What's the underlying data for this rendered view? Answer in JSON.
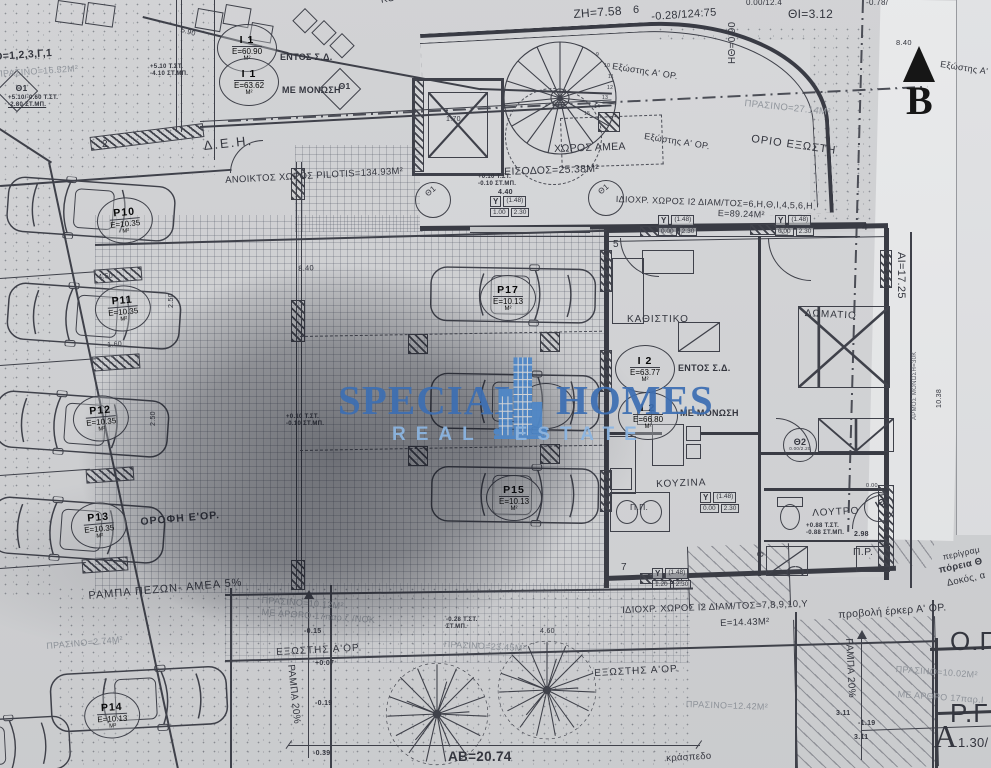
{
  "watermark": {
    "word1": "SPECIAL",
    "word2": "HOMES",
    "tagline": "REAL ESTATE",
    "brand_blue": "#3d6fb3",
    "tagline_blue": "#8cb6e3"
  },
  "north": {
    "label": "B"
  },
  "parking": {
    "p10": {
      "name": "P10",
      "area": "Ε=10.35",
      "unit": "Μ²"
    },
    "p11": {
      "name": "P11",
      "area": "Ε=10.35",
      "unit": "Μ²"
    },
    "p12": {
      "name": "P12",
      "area": "Ε=10.35",
      "unit": "Μ²"
    },
    "p13": {
      "name": "P13",
      "area": "Ε=10.35",
      "unit": "Μ²"
    },
    "p14": {
      "name": "P14",
      "area": "Ε=10.13",
      "unit": "Μ²"
    },
    "p15": {
      "name": "P15",
      "area": "Ε=10.13",
      "unit": "Μ²"
    },
    "p17": {
      "name": "P17",
      "area": "Ε=10.13",
      "unit": "Μ²"
    }
  },
  "units": {
    "i1a": {
      "name": "Ι 1",
      "area": "Ε=60.90",
      "unit": "Μ²",
      "note": "ΕΝΤΟΣ Σ.Δ."
    },
    "i1b": {
      "name": "Ι 1",
      "area": "Ε=63.62",
      "unit": "Μ²",
      "note": "ΜΕ ΜΟΝΩΣΗ"
    },
    "i2a": {
      "name": "Ι 2",
      "area": "Ε=63.77",
      "unit": "Μ²",
      "note": "ΕΝΤΟΣ Σ.Δ."
    },
    "i2b": {
      "name": "Ι 2",
      "area": "Ε=66.80",
      "unit": "Μ²",
      "note": "ΜΕ ΜΟΝΩΣΗ"
    }
  },
  "rooms": {
    "kouzina_top": "ΚΟΥΖΙΝΑ",
    "amea": "ΧΩΡΟΣ ΑΜΕΑ",
    "eisodos": "ΕΙΣΟΔΟΣ=25.38Μ²",
    "kathistiko": "ΚΑΘΙΣΤΙΚΟ",
    "domatio": "ΔΩΜΑΤΙΟ",
    "kouzina": "ΚΟΥΖΙΝΑ",
    "loutro": "ΛΟΥΤΡΟ",
    "pp": "Π.Π.",
    "pr": "Π.Ρ.",
    "pilotis": "ΑΝΟΙΚΤΟΣ ΧΩΡΟΣ PILOTIS=134.93Μ²"
  },
  "areas": {
    "plot_eq": "Ο=1,2,3,Γ,1",
    "prasino_tl": "ΠΡΑΣΙΝΟ=16.52Μ²",
    "prasino_27": "ΠΡΑΣΙΝΟ=27.14Μ²",
    "idioxr_top": "ΙΔΙΟΧΡ. ΧΩΡΟΣ Ι2 ΔΙΑΜ/ΤΟΣ=6,Η,Θ,Ι,4,5,6,Η",
    "e8924": "Ε=89.24Μ²",
    "idioxr_bottom": "ΙΔΙΟΧΡ. ΧΩΡΟΣ Ι2 ΔΙΑΜ/ΤΟΣ=7,8,9,10,Υ",
    "e1443": "Ε=14.43Μ²",
    "prasino_1012": "ΠΡΑΣΙΝΟ=10.12Μ²",
    "me_arthro_l": "ΜΕ ΑΡΘΡΟ 17παρ.ζ /ΝΟΚ",
    "prasino_274": "ΠΡΑΣΙΝΟ=2.74Μ²",
    "prasino_2345": "ΠΡΑΣΙΝΟ=23.45Μ²",
    "prasino_1242": "ΠΡΑΣΙΝΟ=12.42Μ²",
    "prasino_1002": "ΠΡΑΣΙΝΟ=10.02Μ²",
    "me_arthro_r": "ΜΕ ΑΡΘΡΟ 17παρ.Ι"
  },
  "annotations": {
    "deh": "Δ.Ε.Η.",
    "orio_exosti": "ΟΡΙΟ ΕΞΩΣΤΗ",
    "exostis_a": "Εξώστης Α' ΟΡ.",
    "exostis_b": "Εξώστης Α'",
    "exostis_c": "Εξώστης Α' ΟΡ.",
    "orofi": "ΟΡΟΦΗ Ε'ΟΡ.",
    "rampa_pezon": "ΡΑΜΠΑ ΠΕΖΩΝ- ΑΜΕΑ 5%",
    "exostis_left": "ΕΞΩΣΤΗΣ Α'ΟΡ.",
    "exostis_mid": "ΕΞΩΣΤΗΣ Α'ΟΡ.",
    "rampa20_left": "ΡΑΜΠΑ 20%",
    "rampa20_right": "ΡΑΜΠΑ 20%",
    "provoli": "προβολή έρκερ Α' ΟΡ.",
    "og": "Ο.Γ",
    "rg": "Ρ.Γ",
    "a_big": "Α",
    "a_val": "1.30/",
    "perigramma": "περίγραμ",
    "poreia": "πόρεια Θ",
    "dokos": "Δοκός, α",
    "armos": "ΑΡΜΟΣ ΜΟΝΩΣΗ=30Κ",
    "kraspedo": "κράσπεδο"
  },
  "symbols": {
    "theta1": "Θ1",
    "theta2": "Θ2",
    "itheta": "ΙΘ",
    "theta2_sub": "0.00/2.20",
    "itheta_sub": "0.00"
  },
  "dims": {
    "zh": "ΖΗ=7.58",
    "n6": "6",
    "d028": "-0.28/124:75",
    "hth": "ΗΘ=0.90",
    "thi": "ΘΙ=3.12",
    "topcut1": "0.00/12.4",
    "topcut2": "-0.78/",
    "ai": "ΑΙ=17.25",
    "ab": "ΑΒ=20.74",
    "n2": "2",
    "n5": "5",
    "n4": "4",
    "n7": "7",
    "n8": "8",
    "d840a": "8.40",
    "d840b": "8.40",
    "d590": "5.90",
    "d250": "2.50",
    "d250b": "2.50",
    "d450": "4.50",
    "d160": "1.60",
    "d440": "4.40",
    "d170": "1.70",
    "d298": "2.98",
    "d460": "4.60",
    "d311a": "3.11",
    "d119": "-1.19",
    "d311b": "3.11",
    "m015": "-0.15",
    "m007": "+0.07",
    "m019": "-0.19",
    "m039": "-0.39",
    "d1038": "10.38"
  },
  "stair": {
    "s9": "9",
    "s10": "10",
    "s11": "11",
    "s12": "12",
    "s13": "13",
    "s14": "14",
    "s15": "15"
  },
  "levels": {
    "l1a": "+5.10/-0.60 Τ.ΣΤ.",
    "l1b": "-2.80 ΣΤ.ΜΠ.",
    "l2a": "+5.10  Τ.ΣΤ.",
    "l2b": "-4.10  ΣΤ.ΜΠ.",
    "l3a": "+0.10  Τ.ΣΤ.",
    "l3b": "-0.10  ΣΤ.ΜΠ.",
    "l4a": "+0.10  Τ.ΣΤ.",
    "l4b": "-0.10  ΣΤ.ΜΠ.",
    "l5a": "-0.28  Τ.ΣΤ.",
    "l5b": "ΣΤ.ΜΠ.",
    "l6a": "+0.88  Τ.ΣΤ.",
    "l6b": "-0.88  ΣΤ.ΜΠ."
  },
  "ybox": {
    "head": "Υ",
    "cap": "(1.48)",
    "v1a": "1.00",
    "v1b": "2.30",
    "v2a": "0.00",
    "v2b": "2.30",
    "v3a": "1.20",
    "v3b": "2.30"
  }
}
